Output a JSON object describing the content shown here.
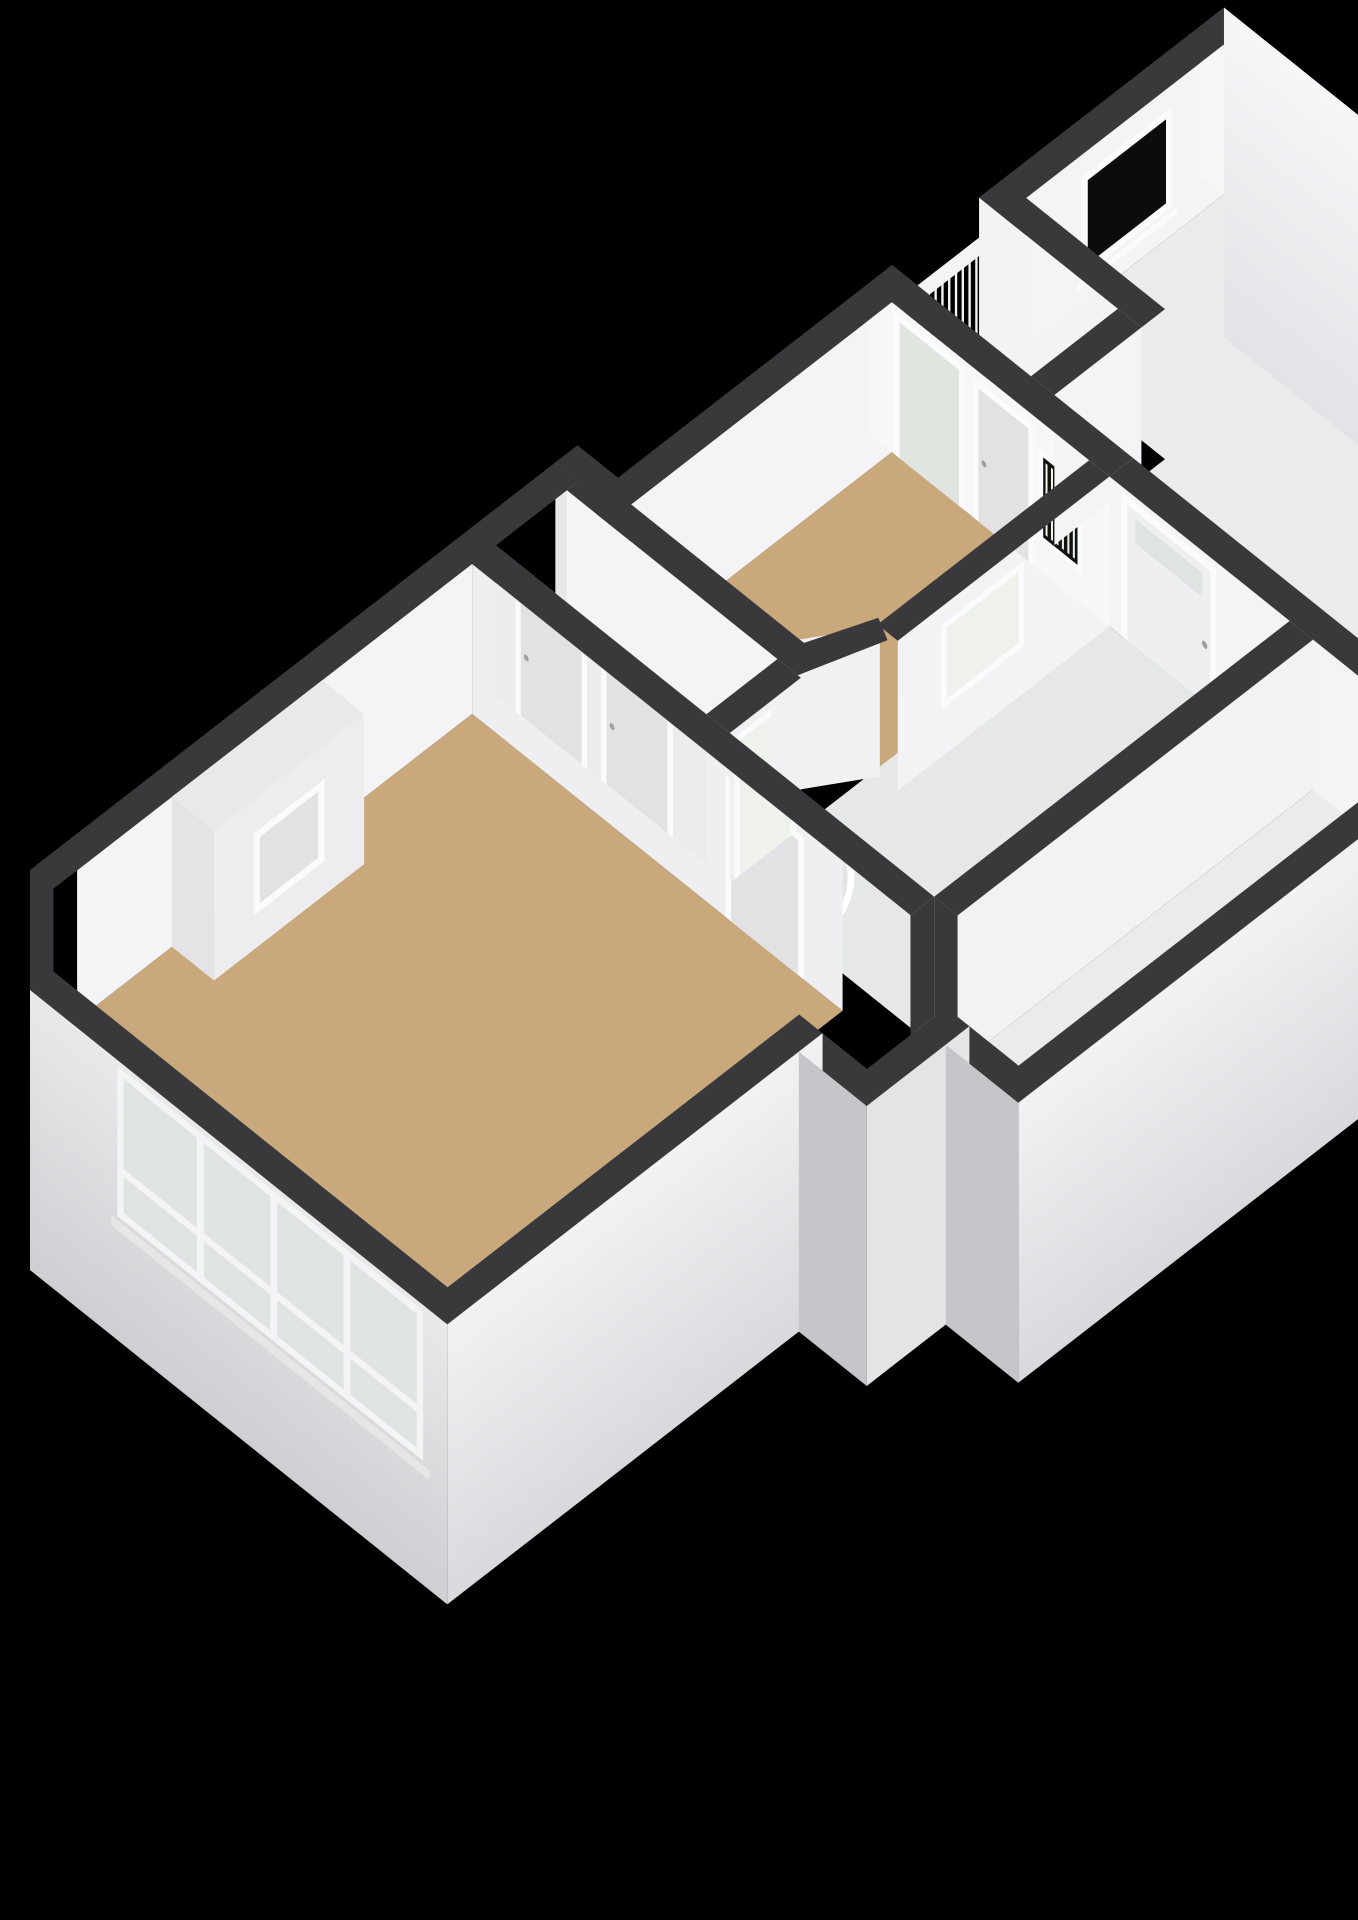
{
  "background": "#000000",
  "colors": {
    "wall_top": "#39393b",
    "wall_top_light": "#e9e9ec",
    "wall_interior": "#f4f4f6",
    "wall_interior_dim": "#ececee",
    "wall_interior_bright": "#f7f7f9",
    "wall_exterior": "#f1f1f4",
    "wall_exterior_bright": "#fafafc",
    "wall_exterior_shadow": "#c6c6ca",
    "wall_exterior_side": "#e7e7ea",
    "floor_wood": "#c9a87b",
    "floor_bath": "#e6e7e7",
    "floor_hall": "#ebebed",
    "floor_balcony": "#d4d8d0",
    "door_leaf": "#e2e2e4",
    "door_leaf_light": "#efeff1",
    "frame": "#fbfbfd",
    "glass_green": "#ccd4c8",
    "glass_pale": "#dfe3e1",
    "glass_frosted": "#eef1ec",
    "glass_black": "#0c0c0e",
    "glass_dark": "#10120f",
    "railing": "#f4f4f6",
    "shower_tray": "#e2e5e2",
    "handle": "#a0a0a3",
    "chimney_side": "#e4e4e7",
    "chimney_front": "#ededef"
  },
  "scene": {
    "type": "3d-floorplan-render",
    "rooms": [
      {
        "name": "living-room",
        "floor": "floor_wood"
      },
      {
        "name": "corridor",
        "floor": "floor_wood"
      },
      {
        "name": "bedroom",
        "floor": "floor_wood"
      },
      {
        "name": "bathroom",
        "floor": "floor_bath"
      },
      {
        "name": "entry-hall",
        "floor": "floor_hall"
      },
      {
        "name": "balcony",
        "floor": "floor_balcony"
      }
    ],
    "features": [
      "chimney-breast",
      "fireplace-panel",
      "window-band-4-panes",
      "balcony-glass-door",
      "balcony-railing",
      "french-balcony-window",
      "interior-doors",
      "corridor-doors",
      "glass-corridor-door",
      "frosted-bathroom-window",
      "black-landing-window",
      "front-door",
      "curved-shower"
    ]
  }
}
